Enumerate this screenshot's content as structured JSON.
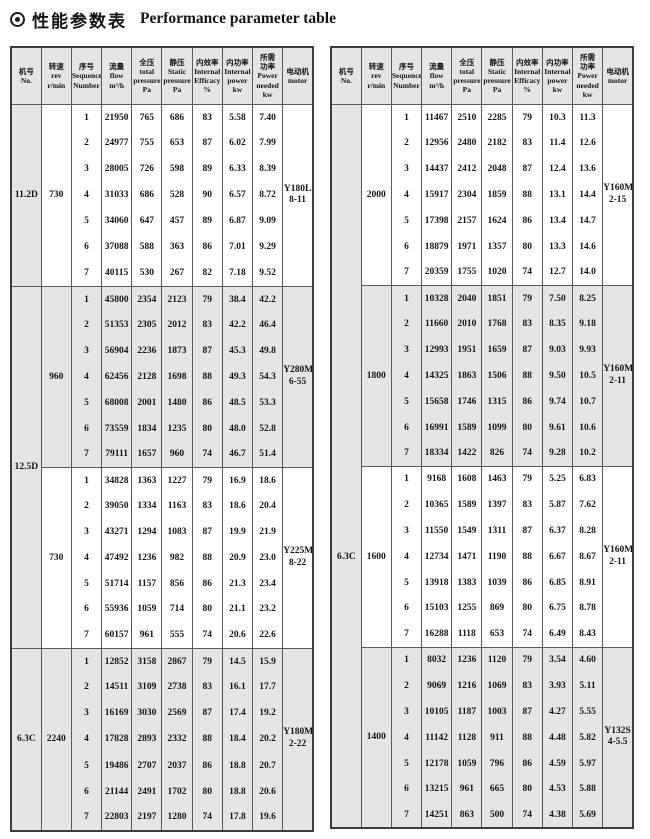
{
  "title": {
    "bullet_icon": "bullseye",
    "zh": "性能参数表",
    "en": "Performance parameter table"
  },
  "colors": {
    "shade": "#e5e5e5",
    "border_outer": "#3d3d3d",
    "border_inner": "#5a5a5a",
    "text": "#141414"
  },
  "seq": [
    "1",
    "2",
    "3",
    "4",
    "5",
    "6",
    "7"
  ],
  "columns": [
    {
      "key": "no",
      "zh": [
        "机号"
      ],
      "en": [
        "No."
      ]
    },
    {
      "key": "rev",
      "zh": [
        "转速"
      ],
      "en": [
        "rev",
        "r/min"
      ]
    },
    {
      "key": "sequence",
      "zh": [
        "序号"
      ],
      "en": [
        "Sequence",
        "Number"
      ]
    },
    {
      "key": "flow",
      "zh": [
        "流量"
      ],
      "en": [
        "flow",
        "m³/h"
      ]
    },
    {
      "key": "total-pressure",
      "zh": [
        "全压"
      ],
      "en": [
        "total",
        "pressure",
        "Pa"
      ]
    },
    {
      "key": "static-pressure",
      "zh": [
        "静压"
      ],
      "en": [
        "Static",
        "pressure",
        "Pa"
      ]
    },
    {
      "key": "internal-efficacy",
      "zh": [
        "内效率"
      ],
      "en": [
        "Internal",
        "Efficacy",
        "%"
      ]
    },
    {
      "key": "internal-power",
      "zh": [
        "内功率"
      ],
      "en": [
        "Internal",
        "power",
        "kw"
      ]
    },
    {
      "key": "power-needed",
      "zh": [
        "所需",
        "功率"
      ],
      "en": [
        "Power",
        "needed",
        "kw"
      ]
    },
    {
      "key": "motor",
      "zh": [
        "电动机"
      ],
      "en": [
        "motor"
      ]
    }
  ],
  "tables": [
    {
      "name": "left-table",
      "no_cells": [
        {
          "label": "11.2D",
          "span": 1,
          "label_group": 0
        },
        {
          "label": "12.5D",
          "span": 2,
          "label_group": 0
        },
        {
          "label": "6.3C",
          "span": 1,
          "label_group": 0
        }
      ],
      "groups": [
        {
          "rev": "730",
          "shaded": false,
          "motor": [
            "Y180L",
            "8-11"
          ],
          "rows": [
            [
              "21950",
              "765",
              "686",
              "83",
              "5.58",
              "7.40"
            ],
            [
              "24977",
              "755",
              "653",
              "87",
              "6.02",
              "7.99"
            ],
            [
              "28005",
              "726",
              "598",
              "89",
              "6.33",
              "8.39"
            ],
            [
              "31033",
              "686",
              "528",
              "90",
              "6.57",
              "8.72"
            ],
            [
              "34060",
              "647",
              "457",
              "89",
              "6.87",
              "9.09"
            ],
            [
              "37088",
              "588",
              "363",
              "86",
              "7.01",
              "9.29"
            ],
            [
              "40115",
              "530",
              "267",
              "82",
              "7.18",
              "9.52"
            ]
          ]
        },
        {
          "rev": "960",
          "shaded": true,
          "motor": [
            "Y280M",
            "6-55"
          ],
          "rows": [
            [
              "45800",
              "2354",
              "2123",
              "79",
              "38.4",
              "42.2"
            ],
            [
              "51353",
              "2305",
              "2012",
              "83",
              "42.2",
              "46.4"
            ],
            [
              "56904",
              "2236",
              "1873",
              "87",
              "45.3",
              "49.8"
            ],
            [
              "62456",
              "2128",
              "1698",
              "88",
              "49.3",
              "54.3"
            ],
            [
              "68008",
              "2001",
              "1480",
              "86",
              "48.5",
              "53.3"
            ],
            [
              "73559",
              "1834",
              "1235",
              "80",
              "48.0",
              "52.8"
            ],
            [
              "79111",
              "1657",
              "960",
              "74",
              "46.7",
              "51.4"
            ]
          ]
        },
        {
          "rev": "730",
          "shaded": false,
          "motor": [
            "Y225M",
            "8-22"
          ],
          "rows": [
            [
              "34828",
              "1363",
              "1227",
              "79",
              "16.9",
              "18.6"
            ],
            [
              "39050",
              "1334",
              "1163",
              "83",
              "18.6",
              "20.4"
            ],
            [
              "43271",
              "1294",
              "1083",
              "87",
              "19.9",
              "21.9"
            ],
            [
              "47492",
              "1236",
              "982",
              "88",
              "20.9",
              "23.0"
            ],
            [
              "51714",
              "1157",
              "856",
              "86",
              "21.3",
              "23.4"
            ],
            [
              "55936",
              "1059",
              "714",
              "80",
              "21.1",
              "23.2"
            ],
            [
              "60157",
              "961",
              "555",
              "74",
              "20.6",
              "22.6"
            ]
          ]
        },
        {
          "rev": "2240",
          "shaded": true,
          "motor": [
            "Y180M",
            "2-22"
          ],
          "rows": [
            [
              "12852",
              "3158",
              "2867",
              "79",
              "14.5",
              "15.9"
            ],
            [
              "14511",
              "3109",
              "2738",
              "83",
              "16.1",
              "17.7"
            ],
            [
              "16169",
              "3030",
              "2569",
              "87",
              "17.4",
              "19.2"
            ],
            [
              "17828",
              "2893",
              "2332",
              "88",
              "18.4",
              "20.2"
            ],
            [
              "19486",
              "2707",
              "2037",
              "86",
              "18.8",
              "20.7"
            ],
            [
              "21144",
              "2491",
              "1702",
              "80",
              "18.8",
              "20.6"
            ],
            [
              "22803",
              "2197",
              "1280",
              "74",
              "17.8",
              "19.6"
            ]
          ]
        }
      ]
    },
    {
      "name": "right-table",
      "no_cells": [
        {
          "label": "6.3C",
          "span": 4,
          "label_group": 1
        }
      ],
      "groups": [
        {
          "rev": "2000",
          "shaded": false,
          "motor": [
            "Y160M2",
            "2-15"
          ],
          "rows": [
            [
              "11467",
              "2510",
              "2285",
              "79",
              "10.3",
              "11.3"
            ],
            [
              "12956",
              "2480",
              "2182",
              "83",
              "11.4",
              "12.6"
            ],
            [
              "14437",
              "2412",
              "2048",
              "87",
              "12.4",
              "13.6"
            ],
            [
              "15917",
              "2304",
              "1859",
              "88",
              "13.1",
              "14.4"
            ],
            [
              "17398",
              "2157",
              "1624",
              "86",
              "13.4",
              "14.7"
            ],
            [
              "18879",
              "1971",
              "1357",
              "80",
              "13.3",
              "14.6"
            ],
            [
              "20359",
              "1755",
              "1020",
              "74",
              "12.7",
              "14.0"
            ]
          ]
        },
        {
          "rev": "1800",
          "shaded": true,
          "motor": [
            "Y160M1",
            "2-11"
          ],
          "rows": [
            [
              "10328",
              "2040",
              "1851",
              "79",
              "7.50",
              "8.25"
            ],
            [
              "11660",
              "2010",
              "1768",
              "83",
              "8.35",
              "9.18"
            ],
            [
              "12993",
              "1951",
              "1659",
              "87",
              "9.03",
              "9.93"
            ],
            [
              "14325",
              "1863",
              "1506",
              "88",
              "9.50",
              "10.5"
            ],
            [
              "15658",
              "1746",
              "1315",
              "86",
              "9.74",
              "10.7"
            ],
            [
              "16991",
              "1589",
              "1099",
              "80",
              "9.61",
              "10.6"
            ],
            [
              "18334",
              "1422",
              "826",
              "74",
              "9.28",
              "10.2"
            ]
          ]
        },
        {
          "rev": "1600",
          "shaded": false,
          "motor": [
            "Y160M1",
            "2-11"
          ],
          "rows": [
            [
              "9168",
              "1608",
              "1463",
              "79",
              "5.25",
              "6.83"
            ],
            [
              "10365",
              "1589",
              "1397",
              "83",
              "5.87",
              "7.62"
            ],
            [
              "11550",
              "1549",
              "1311",
              "87",
              "6.37",
              "8.28"
            ],
            [
              "12734",
              "1471",
              "1190",
              "88",
              "6.67",
              "8.67"
            ],
            [
              "13918",
              "1383",
              "1039",
              "86",
              "6.85",
              "8.91"
            ],
            [
              "15103",
              "1255",
              "869",
              "80",
              "6.75",
              "8.78"
            ],
            [
              "16288",
              "1118",
              "653",
              "74",
              "6.49",
              "8.43"
            ]
          ]
        },
        {
          "rev": "1400",
          "shaded": true,
          "motor": [
            "Y132S",
            "4-5.5"
          ],
          "rows": [
            [
              "8032",
              "1236",
              "1120",
              "79",
              "3.54",
              "4.60"
            ],
            [
              "9069",
              "1216",
              "1069",
              "83",
              "3.93",
              "5.11"
            ],
            [
              "10105",
              "1187",
              "1003",
              "87",
              "4.27",
              "5.55"
            ],
            [
              "11142",
              "1128",
              "911",
              "88",
              "4.48",
              "5.82"
            ],
            [
              "12178",
              "1059",
              "796",
              "86",
              "4.59",
              "5.97"
            ],
            [
              "13215",
              "961",
              "665",
              "80",
              "4.53",
              "5.88"
            ],
            [
              "14251",
              "863",
              "500",
              "74",
              "4.38",
              "5.69"
            ]
          ]
        }
      ]
    }
  ]
}
